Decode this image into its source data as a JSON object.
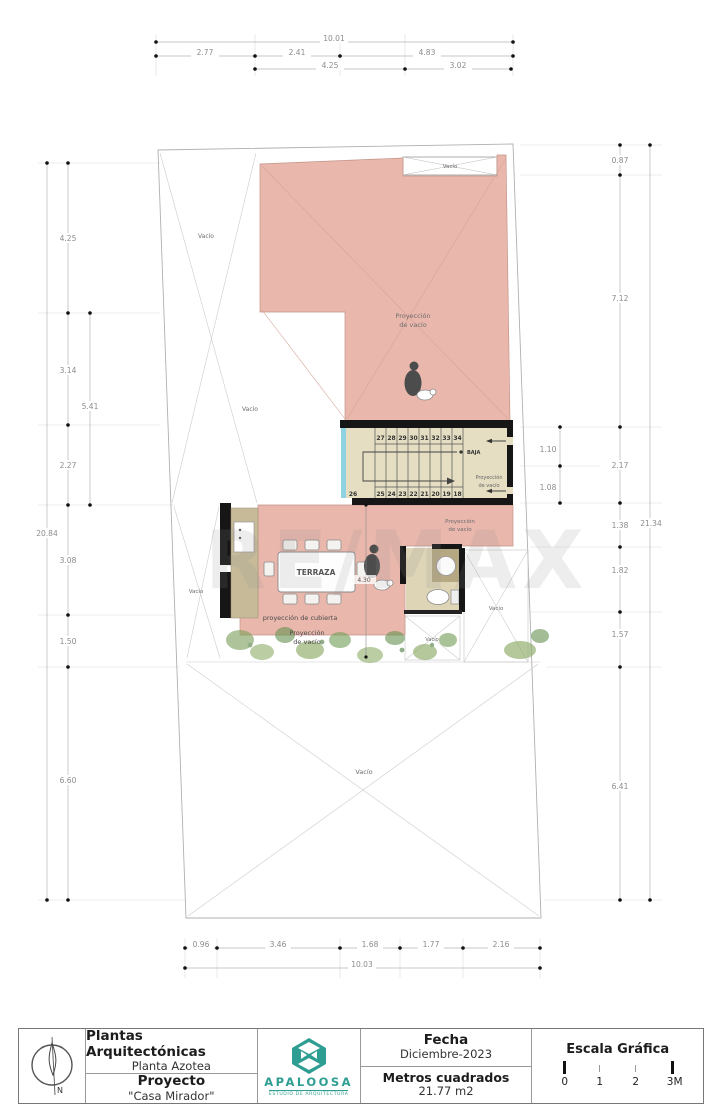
{
  "watermark": "RE/MAX",
  "labels": {
    "vacio": "Vacío",
    "proyeccion": "Proyección",
    "de_vacio": "de vacío",
    "proyeccion_line": "Proyección",
    "cubierta": "proyección de cubierta",
    "terraza": "TERRAZA",
    "baja": "BAJA",
    "dim_430": "4.30"
  },
  "stairs": {
    "top_numbers": [
      "27",
      "28",
      "29",
      "30",
      "31",
      "32",
      "33",
      "34"
    ],
    "bottom_numbers": [
      "25",
      "24",
      "23",
      "22",
      "21",
      "20",
      "19",
      "18"
    ],
    "landing_number": "26"
  },
  "dims": {
    "top": [
      "10.01",
      "2.77",
      "2.41",
      "4.83",
      "4.25",
      "3.02"
    ],
    "bottom": [
      "0.96",
      "3.46",
      "1.68",
      "1.77",
      "2.16",
      "10.03"
    ],
    "left": [
      "4.25",
      "3.14",
      "5.41",
      "2.27",
      "3.08",
      "1.50",
      "6.60",
      "20.84"
    ],
    "right": [
      "0.87",
      "7.12",
      "1.10",
      "2.17",
      "1.08",
      "1.38",
      "1.82",
      "1.57",
      "6.41",
      "21.34"
    ]
  },
  "title_block": {
    "sheet_title": "Plantas Arquitectónicas",
    "sheet_subtitle": "Planta Azotea",
    "project_label": "Proyecto",
    "project_name": "\"Casa Mirador\"",
    "logo_name": "APALOOSA",
    "logo_sub": "ESTUDIO DE ARQUITECTURA",
    "date_label": "Fecha",
    "date_value": "Diciembre-2023",
    "area_label": "Metros cuadrados",
    "area_value": "21.77 m2",
    "scale_label": "Escala Gráfica",
    "scale_ticks": [
      "0",
      "1",
      "2",
      "3M"
    ],
    "north_label": "N"
  },
  "colors": {
    "roof_pink": "#e9b7ac",
    "stair_beige": "#e5dec2",
    "counter_tan": "#c6ba99",
    "accent_cyan": "#8fd3e3",
    "logo_teal": "#2f9e92",
    "wall_black": "#161616"
  }
}
